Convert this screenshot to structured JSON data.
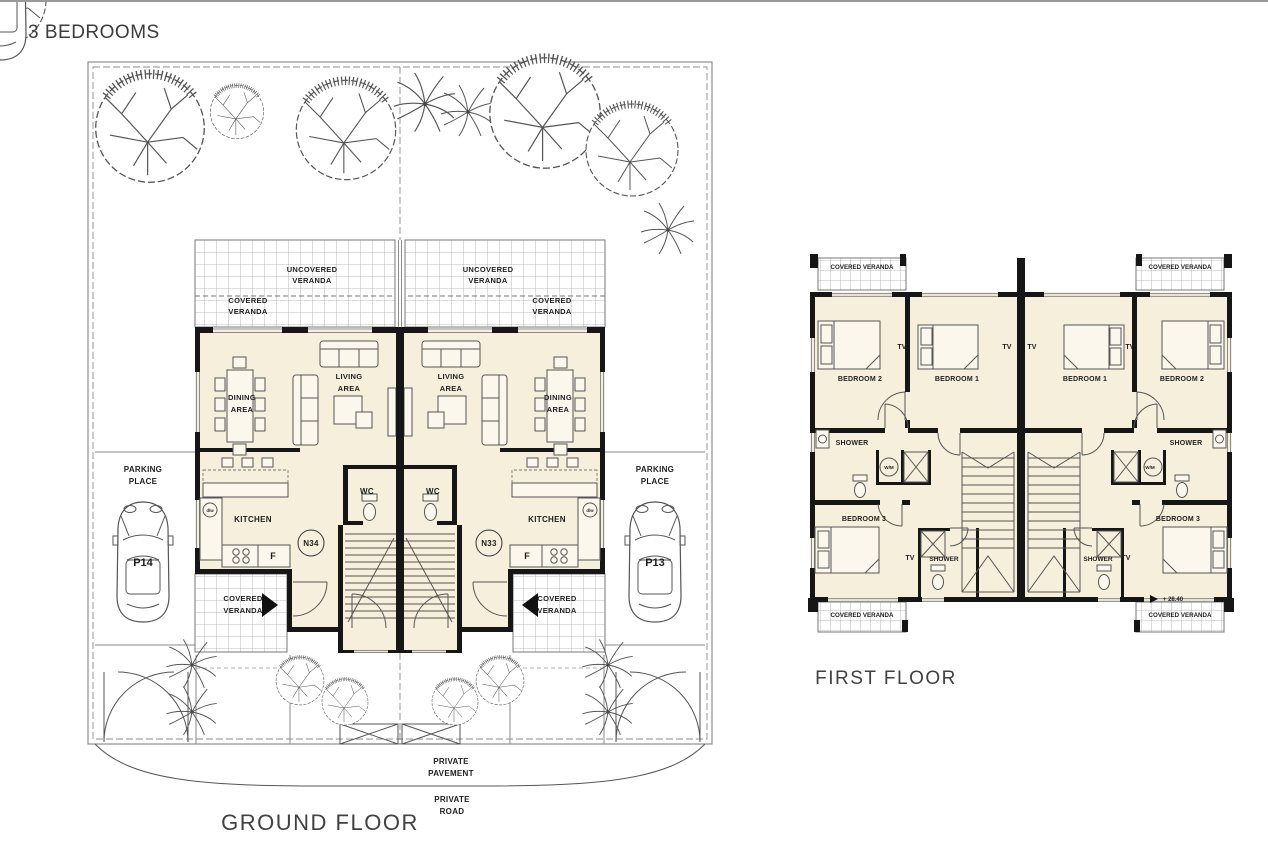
{
  "page": {
    "title": "3 BEDROOMS"
  },
  "captions": {
    "ground_floor": "GROUND FLOOR",
    "first_floor": "FIRST FLOOR"
  },
  "site": {
    "private": "PRIVATE",
    "pavement": "PAVEMENT",
    "road": "ROAD"
  },
  "labels": {
    "uncovered": "UNCOVERED",
    "covered": "COVERED",
    "veranda": "VERANDA",
    "covered_veranda": "COVERED VERANDA",
    "living": "LIVING",
    "dining": "DINING",
    "area": "AREA",
    "kitchen": "KITCHEN",
    "wc": "WC",
    "fridge": "F",
    "dishwasher": "d/w",
    "parking": "PARKING",
    "place": "PLACE",
    "shower": "SHOWER",
    "washing_machine": "W/M",
    "tv": "TV",
    "bedroom_1": "BEDROOM 1",
    "bedroom_2": "BEDROOM 2",
    "bedroom_3": "BEDROOM 3"
  },
  "units": {
    "left": {
      "number": "N34",
      "parking_no": "P14"
    },
    "right": {
      "number": "N33",
      "parking_no": "P13"
    }
  },
  "first_floor": {
    "level_mark": "+ 28.40"
  }
}
